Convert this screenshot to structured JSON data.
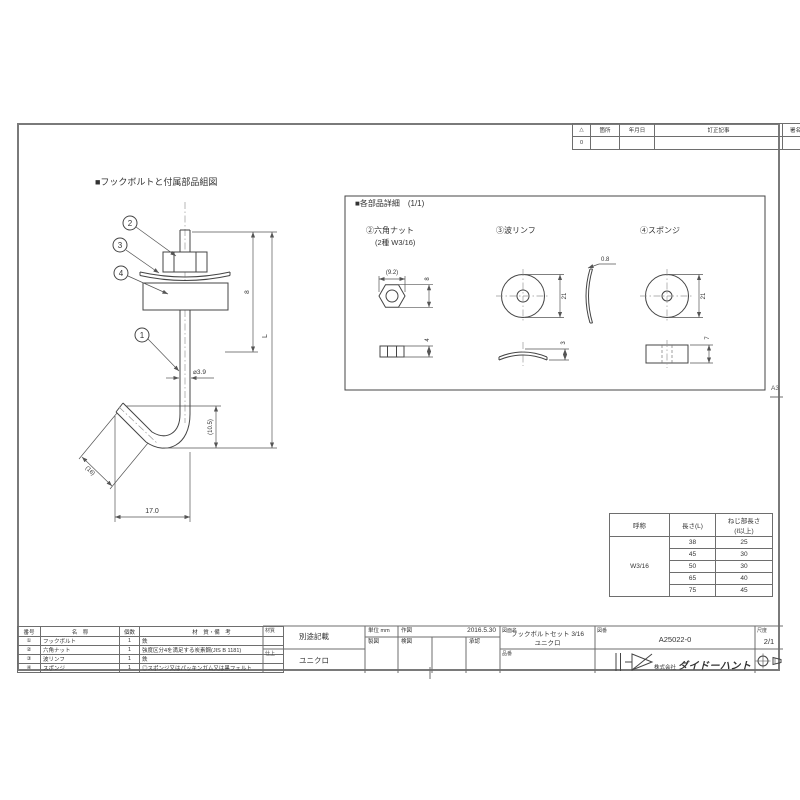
{
  "sheet": {
    "size_label": "A3"
  },
  "revision_table": {
    "headers": [
      "△",
      "箇所",
      "年月日",
      "訂正記事",
      "署名"
    ],
    "rows": [
      {
        "mark": "0"
      }
    ]
  },
  "assembly": {
    "title": "■フックボルトと付属部品組図",
    "callouts": {
      "bolt": "1",
      "nut": "2",
      "washer": "3",
      "sponge": "4"
    },
    "dims": {
      "rod_dia": "⌀3.9",
      "stack": "8",
      "overall": "L",
      "hook_depth": "(10.5)",
      "hook_length": "(16)",
      "hook_width": "17.0"
    }
  },
  "details": {
    "title": "■各部品詳細　(1/1)",
    "nut": {
      "label": "②六角ナット",
      "sub": "(2種 W3/16)",
      "dim_across": "(9.2)",
      "dim_dia": "8",
      "dim_height": "4"
    },
    "washer": {
      "label": "③波リンフ",
      "dim_dia": "21",
      "dim_height": "3",
      "dim_thickness": "0.8"
    },
    "sponge": {
      "label": "④スポンジ",
      "dim_dia": "21",
      "dim_height": "7"
    }
  },
  "spec_table": {
    "col_name": "呼称",
    "col_length": "長さ(L)",
    "col_thread": "ねじ部長さ\n(ℓ以上)",
    "name": "W3/16",
    "rows": [
      [
        "38",
        "25"
      ],
      [
        "45",
        "30"
      ],
      [
        "50",
        "30"
      ],
      [
        "65",
        "40"
      ],
      [
        "75",
        "45"
      ]
    ]
  },
  "parts_list": {
    "headers": [
      "番号",
      "名　称",
      "個数",
      "材　質・備　考"
    ],
    "rows": [
      [
        "①",
        "フックボルト",
        "1",
        "鉄"
      ],
      [
        "②",
        "六角ナット",
        "1",
        "強度区分4を満足する炭素鋼(JIS B 1181)"
      ],
      [
        "③",
        "波リンフ",
        "1",
        "鉄"
      ],
      [
        "④",
        "スポンジ",
        "1",
        "◎スポンジ又はパッキンガム又は黒フェルト"
      ]
    ]
  },
  "title_block": {
    "material_label": "材質",
    "material_value": "別途記載",
    "finish_label": "仕上",
    "finish_value": "ユニクロ",
    "unit_text": "単位 mm",
    "drawn_label": "作図",
    "drawn_date": "2016.5.30",
    "draft_label": "製図",
    "check_label": "検図",
    "approve_label": "承認",
    "name_label": "図面名",
    "drawing_name_line1": "フックボルトセット 3/16",
    "drawing_name_line2": "ユニクロ",
    "part_no_label": "品番",
    "dwg_no_label": "図番",
    "dwg_no": "A25022-0",
    "scale_label": "尺度",
    "scale_value": "2/1",
    "company_prefix": "株式会社",
    "company_name": "ダイドーハント"
  }
}
